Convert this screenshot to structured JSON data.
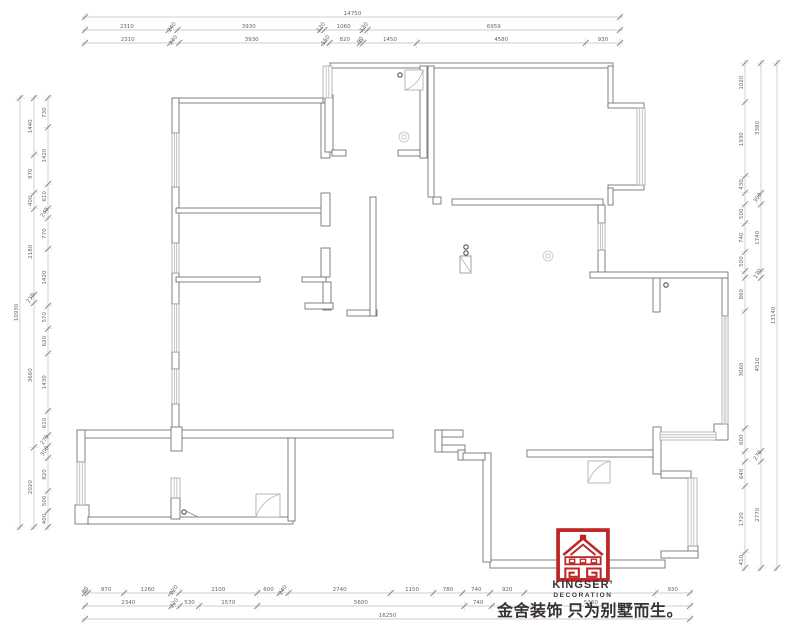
{
  "colors": {
    "background": "#ffffff",
    "wall": "#757575",
    "window": "#999999",
    "dim_line": "#bcbcbc",
    "dim_text": "#666666",
    "tick": "#8a8a8a",
    "symbol": "#555555",
    "light_symbol": "#c2c2c2",
    "logo_red": "#bf2626",
    "brand_text": "#3a3336"
  },
  "logo": {
    "brand": "KINGSER’",
    "sub": "DECORATION",
    "slogan": "金舍装饰 只为别墅而生。"
  },
  "dimensions": {
    "top": [
      {
        "orient": "h",
        "pos": 17,
        "from": 85,
        "to": 620,
        "segments": [
          [
            14750,
            "14750"
          ]
        ]
      },
      {
        "orient": "h",
        "pos": 30,
        "from": 85,
        "to": 620,
        "segments": [
          [
            2310,
            "2310"
          ],
          [
            240,
            "240"
          ],
          [
            3930,
            "3930"
          ],
          [
            120,
            "120"
          ],
          [
            1060,
            "1060"
          ],
          [
            130,
            "130"
          ],
          [
            6959,
            "6959"
          ]
        ]
      },
      {
        "orient": "h",
        "pos": 43,
        "from": 85,
        "to": 620,
        "segments": [
          [
            2310,
            "2310"
          ],
          [
            240,
            "240"
          ],
          [
            3930,
            "3930"
          ],
          [
            150,
            "150"
          ],
          [
            820,
            "820"
          ],
          [
            90,
            "90"
          ],
          [
            1450,
            "1450"
          ],
          [
            4580,
            "4580"
          ],
          [
            930,
            "930"
          ]
        ]
      }
    ],
    "left": [
      {
        "orient": "v",
        "pos": 20,
        "from": 98,
        "to": 527,
        "segments": [
          [
            10930,
            "10930"
          ]
        ]
      },
      {
        "orient": "v",
        "pos": 34,
        "from": 98,
        "to": 527,
        "segments": [
          [
            1440,
            "1440"
          ],
          [
            970,
            "970"
          ],
          [
            400,
            "400"
          ],
          [
            2180,
            "2180"
          ],
          [
            210,
            "210"
          ],
          [
            3660,
            "3660"
          ],
          [
            2020,
            "2020"
          ]
        ]
      },
      {
        "orient": "v",
        "pos": 48,
        "from": 98,
        "to": 527,
        "segments": [
          [
            730,
            "730"
          ],
          [
            1420,
            "1420"
          ],
          [
            610,
            "610"
          ],
          [
            240,
            "240"
          ],
          [
            770,
            "770"
          ],
          [
            1420,
            "1420"
          ],
          [
            570,
            "570"
          ],
          [
            620,
            "620"
          ],
          [
            1430,
            "1430"
          ],
          [
            610,
            "610"
          ],
          [
            270,
            "270"
          ],
          [
            300,
            "300"
          ],
          [
            820,
            "820"
          ],
          [
            500,
            "500"
          ],
          [
            400,
            "400"
          ]
        ]
      }
    ],
    "right": [
      {
        "orient": "v",
        "pos": 745,
        "from": 63,
        "to": 568,
        "segments": [
          [
            1020,
            "1020"
          ],
          [
            1930,
            "1930"
          ],
          [
            430,
            "430"
          ],
          [
            300,
            ""
          ],
          [
            500,
            "500"
          ],
          [
            740,
            "740"
          ],
          [
            500,
            "500"
          ],
          [
            170,
            ""
          ],
          [
            860,
            "860"
          ],
          [
            3060,
            "3060"
          ],
          [
            600,
            "600"
          ],
          [
            270,
            ""
          ],
          [
            640,
            "640"
          ],
          [
            1720,
            "1720"
          ],
          [
            410,
            "410"
          ]
        ]
      },
      {
        "orient": "v",
        "pos": 761,
        "from": 63,
        "to": 568,
        "segments": [
          [
            3380,
            "3380"
          ],
          [
            300,
            "300"
          ],
          [
            1740,
            "1740"
          ],
          [
            170,
            "170"
          ],
          [
            4510,
            "4510"
          ],
          [
            270,
            "270"
          ],
          [
            2770,
            "2770"
          ]
        ]
      },
      {
        "orient": "v",
        "pos": 777,
        "from": 63,
        "to": 568,
        "segments": [
          [
            13140,
            "13140"
          ]
        ]
      }
    ],
    "bottom": [
      {
        "orient": "h",
        "pos": 593,
        "from": 85,
        "to": 690,
        "segments": [
          [
            80,
            "80"
          ],
          [
            970,
            "970"
          ],
          [
            1260,
            "1260"
          ],
          [
            220,
            "220"
          ],
          [
            2100,
            "2100"
          ],
          [
            600,
            "600"
          ],
          [
            240,
            "240"
          ],
          [
            2740,
            "2740"
          ],
          [
            1150,
            "1150"
          ],
          [
            780,
            "780"
          ],
          [
            740,
            "740"
          ],
          [
            920,
            "920"
          ],
          [
            3520,
            ""
          ],
          [
            930,
            "930"
          ]
        ]
      },
      {
        "orient": "h",
        "pos": 606,
        "from": 85,
        "to": 690,
        "segments": [
          [
            2340,
            "2340"
          ],
          [
            220,
            "220"
          ],
          [
            530,
            "530"
          ],
          [
            1570,
            "1570"
          ],
          [
            5600,
            "5600"
          ],
          [
            740,
            "740"
          ],
          [
            5360,
            "5360"
          ]
        ]
      },
      {
        "orient": "h",
        "pos": 619,
        "from": 85,
        "to": 690,
        "segments": [
          [
            16250,
            "16250"
          ]
        ]
      }
    ]
  }
}
